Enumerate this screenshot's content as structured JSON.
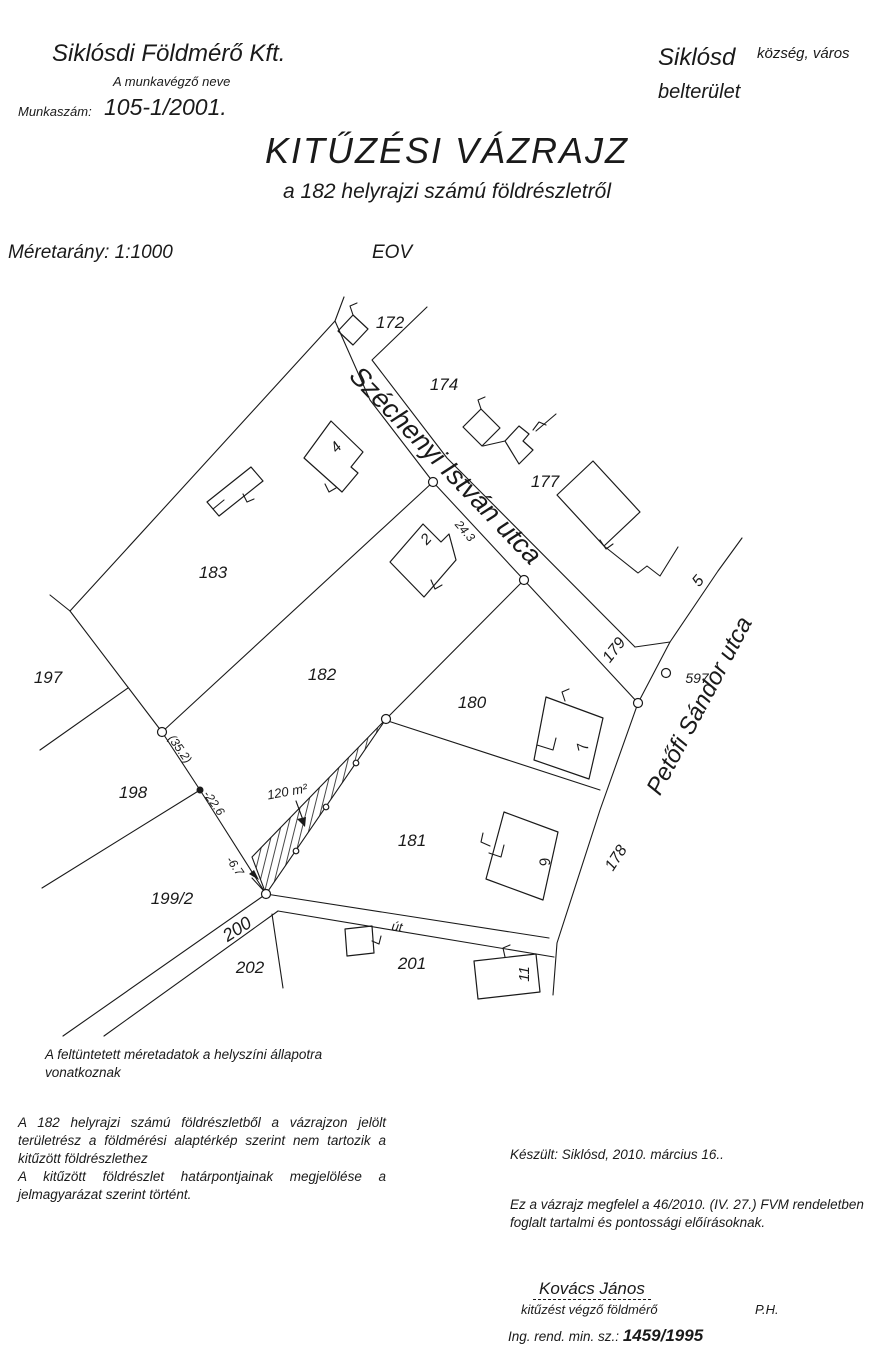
{
  "header": {
    "company": "Siklósdi Földmérő Kft.",
    "company_caption": "A munkavégző neve",
    "work_number_label": "Munkaszám:",
    "work_number": "105-1/2001.",
    "settlement": "Siklósd",
    "settlement_caption": "község, város",
    "area_type": "belterület"
  },
  "title": {
    "main": "KITŰZÉSI VÁZRAJZ",
    "subtitle": "a 182 helyrajzi számú földrészletről",
    "scale": "Méretarány: 1:1000",
    "projection": "EOV"
  },
  "map": {
    "street_names": {
      "szechenyi": "Széchenyi István utca",
      "petofi": "Petőfi Sándor utca"
    },
    "parcel_numbers": {
      "p172": "172",
      "p174": "174",
      "p177": "177",
      "p179": "179",
      "p183": "183",
      "p197": "197",
      "p182": "182",
      "p180": "180",
      "p198": "198",
      "p181": "181",
      "p199_2": "199/2",
      "p178": "178",
      "p200": "200",
      "p201": "201",
      "p202": "202"
    },
    "house_numbers": {
      "h2": "2",
      "h4": "4",
      "h5": "5",
      "h7": "7",
      "h9": "9",
      "h11": "11"
    },
    "point_number": "597",
    "measurements": {
      "frontage": "24.3",
      "side_total": "(35.2)",
      "side_lower": "-22.6",
      "closing": "-6.7"
    },
    "area_label": "120 m²",
    "road_label": "út"
  },
  "notes": {
    "note1": "A feltüntetett méretadatok a helyszíni állapotra vonatkoznak",
    "note2": "A 182 helyrajzi számú földrészletből a vázrajzon jelölt területrész a földmérési alaptérkép szerint nem tartozik a kitűzött földrészlethez",
    "note3": "A kitűzött földrészlet határpontjainak megjelölése a jelmagyarázat szerint történt."
  },
  "footer": {
    "made_at": "Készült: Siklósd, 2010. március 16..",
    "law": "Ez a vázrajz megfelel a 46/2010. (IV. 27.) FVM rendeletben foglalt tartalmi és pontossági előírásoknak.",
    "surveyor_name": "Kovács János",
    "surveyor_role": "kitűzést végző földmérő",
    "stamp": "P.H.",
    "license_label": "Ing. rend. min. sz.:",
    "license_number": "1459/1995"
  },
  "colors": {
    "ink": "#1a1a1a",
    "paper": "#ffffff"
  }
}
